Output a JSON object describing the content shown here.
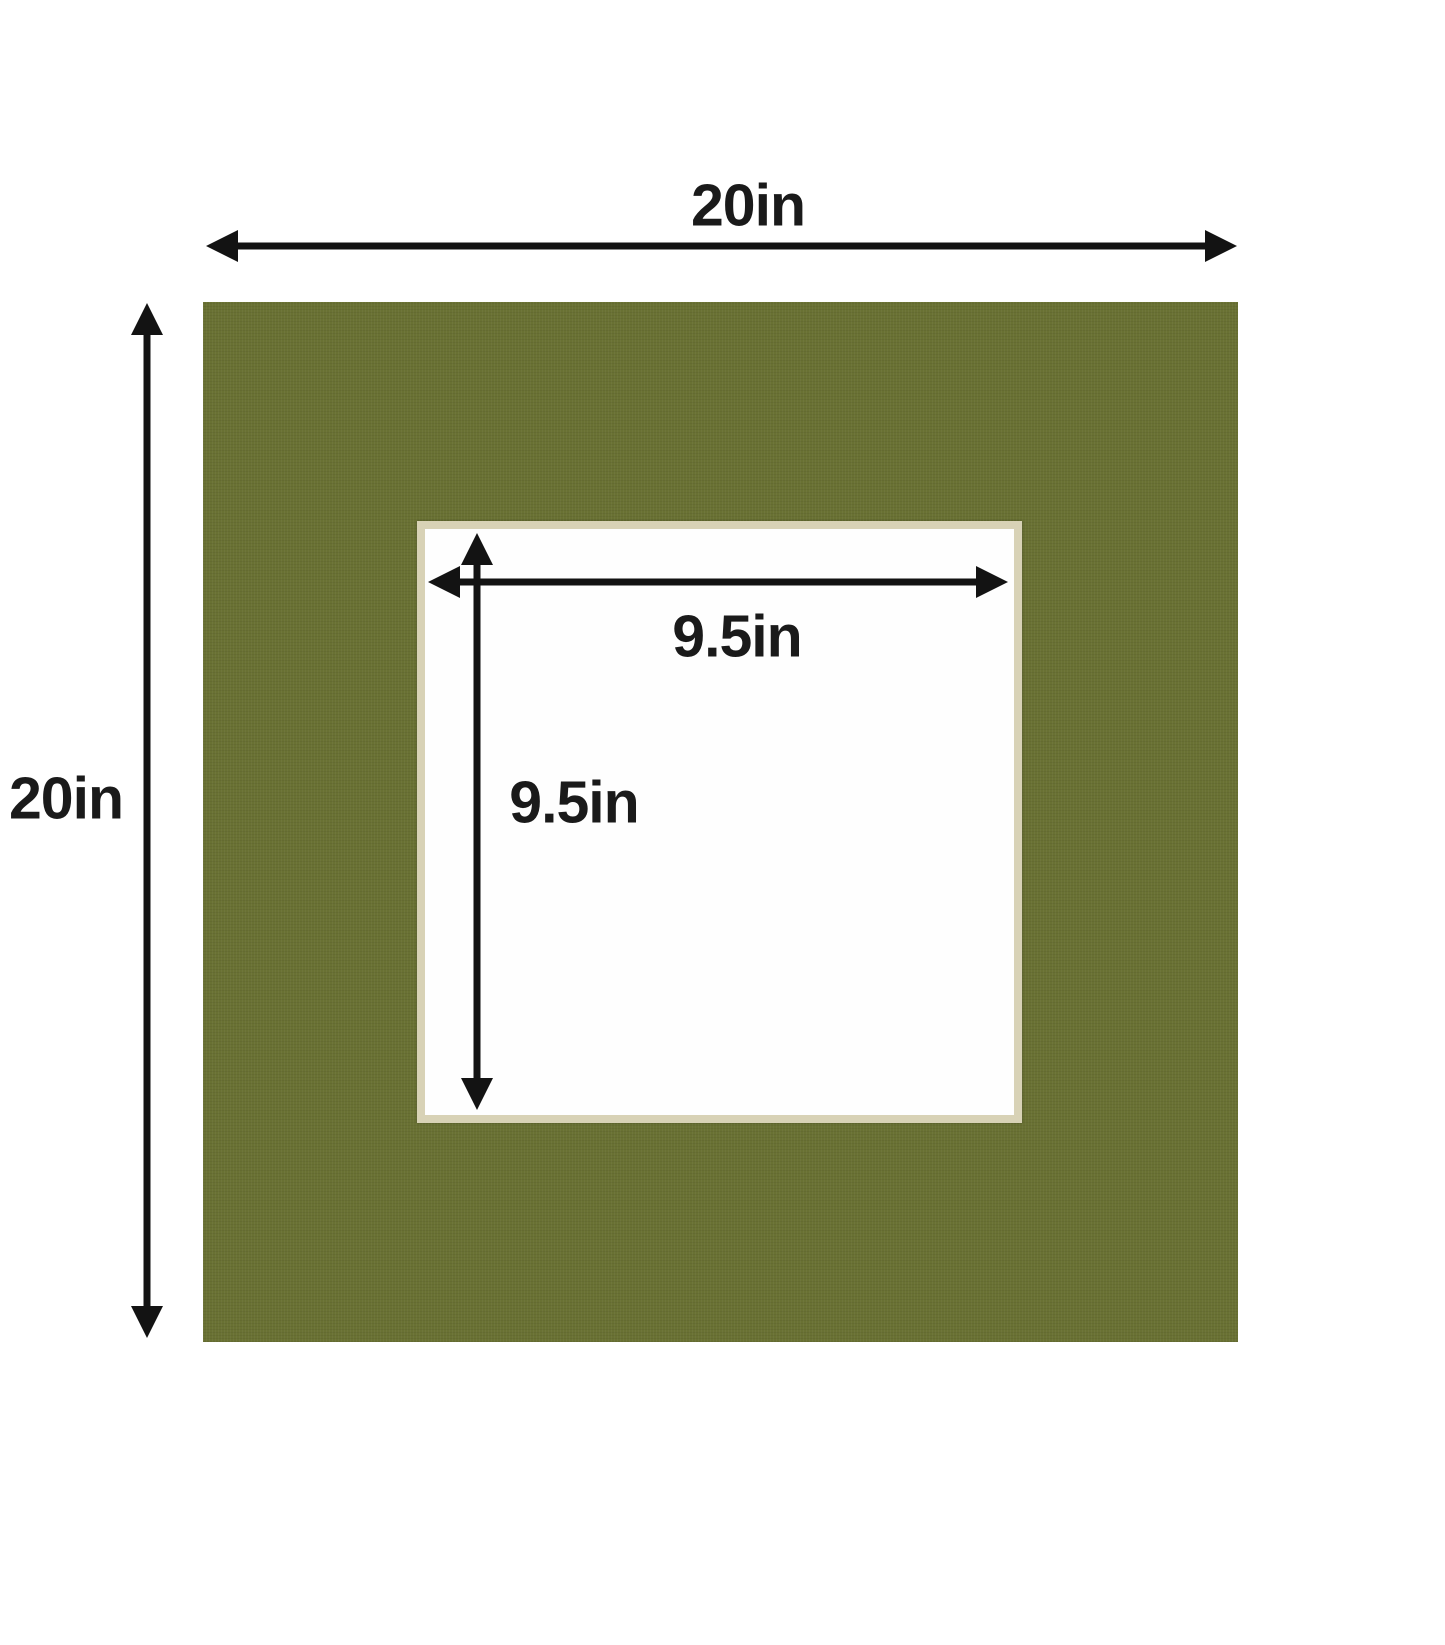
{
  "diagram": {
    "outer": {
      "width_label": "20in",
      "height_label": "20in"
    },
    "window": {
      "width_label": "9.5in",
      "height_label": "9.5in"
    }
  },
  "colors": {
    "background": "#ffffff",
    "mat": "#697133",
    "bevel": "#d8d2b6",
    "window": "#fefefe",
    "arrow": "#131313",
    "label": "#1a1a1a"
  }
}
